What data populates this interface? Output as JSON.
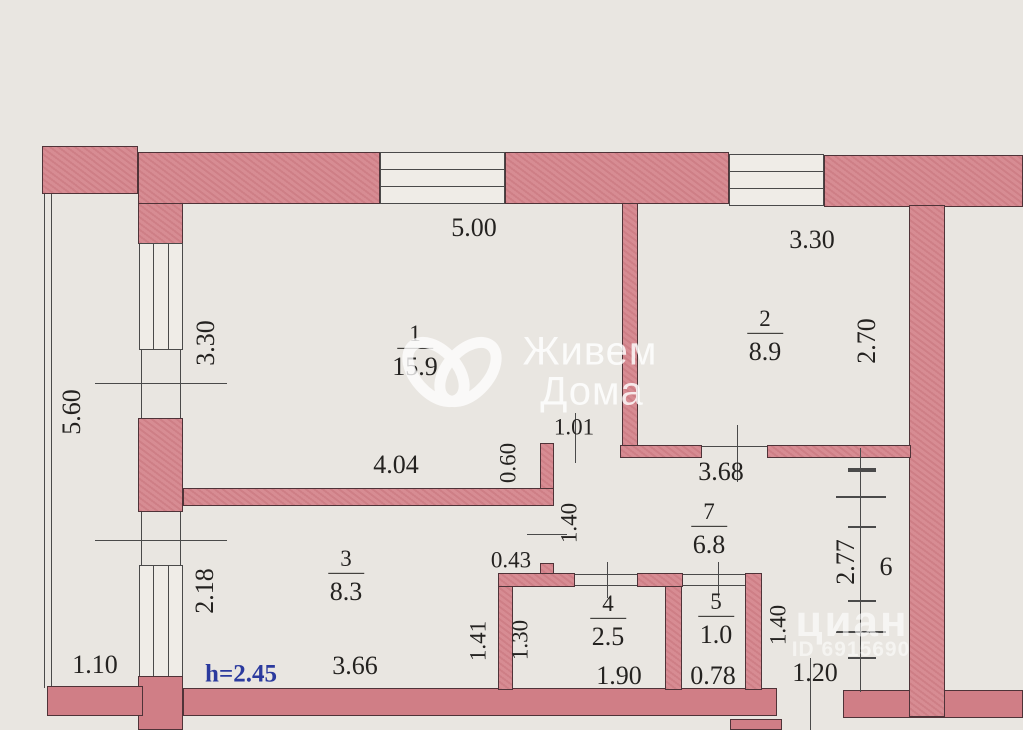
{
  "colors": {
    "wall_fill": "#d5868d",
    "paper": "#e9e6e1",
    "height_note_color": "#2b3a9e",
    "line_color": "#4a4a4a"
  },
  "rooms": [
    {
      "num": "1",
      "area": "15.9"
    },
    {
      "num": "2",
      "area": "8.9"
    },
    {
      "num": "3",
      "area": "8.3"
    },
    {
      "num": "4",
      "area": "2.5"
    },
    {
      "num": "5",
      "area": "1.0"
    },
    {
      "num": "6",
      "area": ""
    },
    {
      "num": "7",
      "area": "6.8"
    }
  ],
  "dims": {
    "room1_top": "5.00",
    "room2_top": "3.30",
    "room1_left": "3.30",
    "room2_right": "2.70",
    "balcony_left": "5.60",
    "room1_bottom": "4.04",
    "jog_060": "0.60",
    "door_101": "1.01",
    "hall_top": "3.68",
    "door_140_left": "1.40",
    "jog_043": "0.43",
    "room3_left": "2.18",
    "corridor_right": "2.77",
    "room3_right_141": "1.41",
    "room4_left_130": "1.30",
    "hall_right_140": "1.40",
    "balcony_bottom": "1.10",
    "room3_bottom": "3.66",
    "room4_bottom": "1.90",
    "room5_bottom": "0.78",
    "entry_bottom": "1.20"
  },
  "height_note": "h=2.45",
  "watermarks": {
    "center_logo": "heart-loops-logo",
    "center_line1": "Живем",
    "center_line2": "Дома",
    "corner_brand": "циан",
    "corner_id": "ID 6915690"
  }
}
